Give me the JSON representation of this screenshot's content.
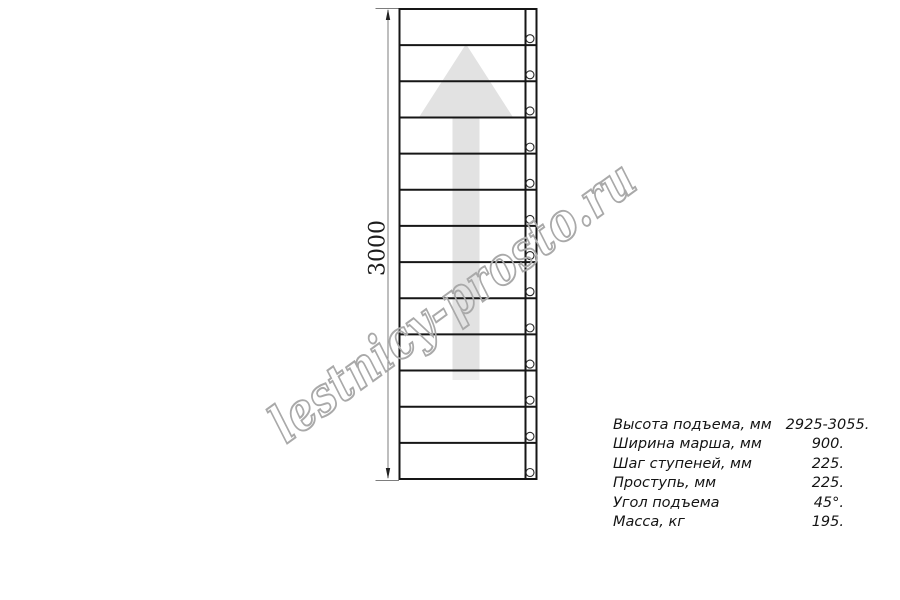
{
  "page": {
    "background": "#ffffff"
  },
  "drawing": {
    "type": "ladder-top-view",
    "dimension_label": "3000",
    "steps": 13,
    "line_color": "#161616",
    "arrow_color": "#e2e2e2",
    "arrow_tail_color": "#ededed",
    "dimension_line_color": "#7d7d7d",
    "hole_stroke_color": "#2a2a2a"
  },
  "watermark": {
    "text": "lestnicy-prosto.ru",
    "outline_color": "#a9a9a9"
  },
  "specs": {
    "rows": [
      {
        "label": "Высота подъема, мм",
        "value": "2925-3055."
      },
      {
        "label": "Ширина марша, мм",
        "value": "900."
      },
      {
        "label": "Шаг ступеней, мм",
        "value": "225."
      },
      {
        "label": "Проступь, мм",
        "value": "225."
      },
      {
        "label": "Угол подъема",
        "value": "45°."
      },
      {
        "label": "Масса, кг",
        "value": "195."
      }
    ]
  }
}
